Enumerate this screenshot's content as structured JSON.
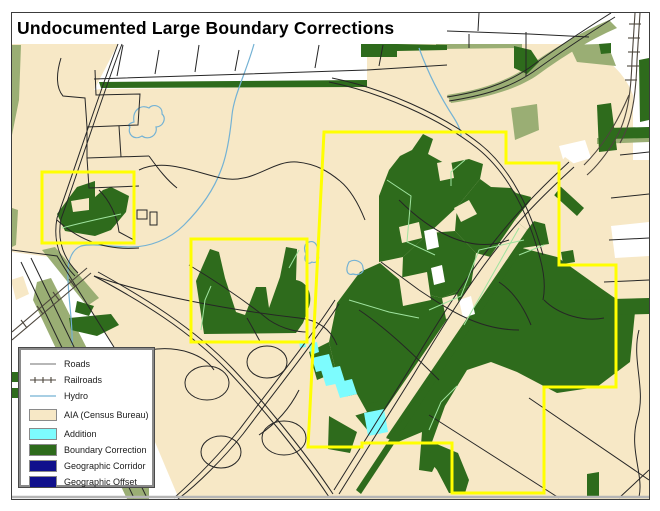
{
  "title": "Undocumented Large Boundary Corrections",
  "legend": {
    "items": [
      {
        "label": "Roads",
        "type": "line",
        "color": "#8c8c8c"
      },
      {
        "label": "Railroads",
        "type": "railroad",
        "color": "#4d463d"
      },
      {
        "label": "Hydro",
        "type": "line",
        "color": "#74b2d4"
      },
      {
        "label": "AIA (Census Bureau)",
        "type": "fill",
        "color": "#f7e8c6",
        "border": "#8a8a8a"
      },
      {
        "label": "Addition",
        "type": "fill",
        "color": "#7dfcfe",
        "border": "#8a8a8a"
      },
      {
        "label": "Boundary Correction",
        "type": "fill",
        "color": "#2e6b1c",
        "border": "#8a8a8a"
      },
      {
        "label": "Geographic Corridor",
        "type": "fill",
        "color": "#10108c",
        "border": "#8a8a8a"
      },
      {
        "label": "Geographic Offset",
        "type": "fill",
        "color": "#10108c",
        "border": "#8a8a8a"
      }
    ]
  },
  "map": {
    "colors": {
      "aia": "#f7e8c6",
      "white": "#ffffff",
      "boundary_correction": "#2e6b1c",
      "olive": "#9aae74",
      "addition": "#7dfcfe",
      "yellow_boundary": "#ffff00",
      "hydro": "#74b2d4",
      "road": "#262626",
      "road_gray": "#8a8172",
      "rail": "#4d463d",
      "interior_line": "#9fe39f",
      "border_gray": "#b5b5b5"
    }
  }
}
